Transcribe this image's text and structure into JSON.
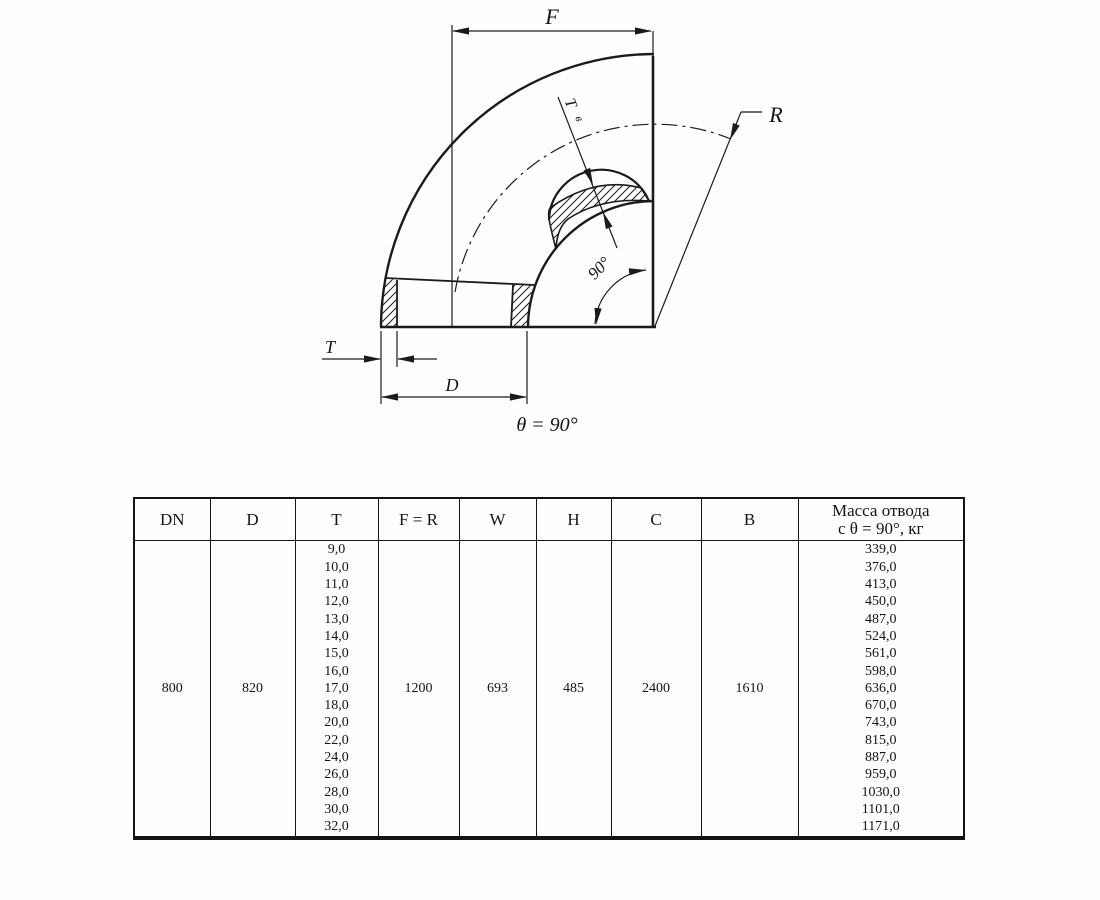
{
  "drawing": {
    "caption": "θ = 90°",
    "labels": {
      "f": "F",
      "r": "R",
      "t": "T",
      "d": "D",
      "tv_main": "T",
      "tv_sub": "в",
      "angle": "90°"
    }
  },
  "table": {
    "headers": [
      "DN",
      "D",
      "T",
      "F = R",
      "W",
      "H",
      "C",
      "B"
    ],
    "mass_header": [
      "Масса отвода",
      "с θ =  90°, кг"
    ],
    "values": {
      "dn": "800",
      "d": "820",
      "fr": "1200",
      "w": "693",
      "h": "485",
      "c": "2400",
      "b": "1610"
    },
    "t_values": [
      "9,0",
      "10,0",
      "11,0",
      "12,0",
      "13,0",
      "14,0",
      "15,0",
      "16,0",
      "17,0",
      "18,0",
      "20,0",
      "22,0",
      "24,0",
      "26,0",
      "28,0",
      "30,0",
      "32,0"
    ],
    "mass_values": [
      "339,0",
      "376,0",
      "413,0",
      "450,0",
      "487,0",
      "524,0",
      "561,0",
      "598,0",
      "636,0",
      "670,0",
      "743,0",
      "815,0",
      "887,0",
      "959,0",
      "1030,0",
      "1101,0",
      "1171,0"
    ]
  }
}
